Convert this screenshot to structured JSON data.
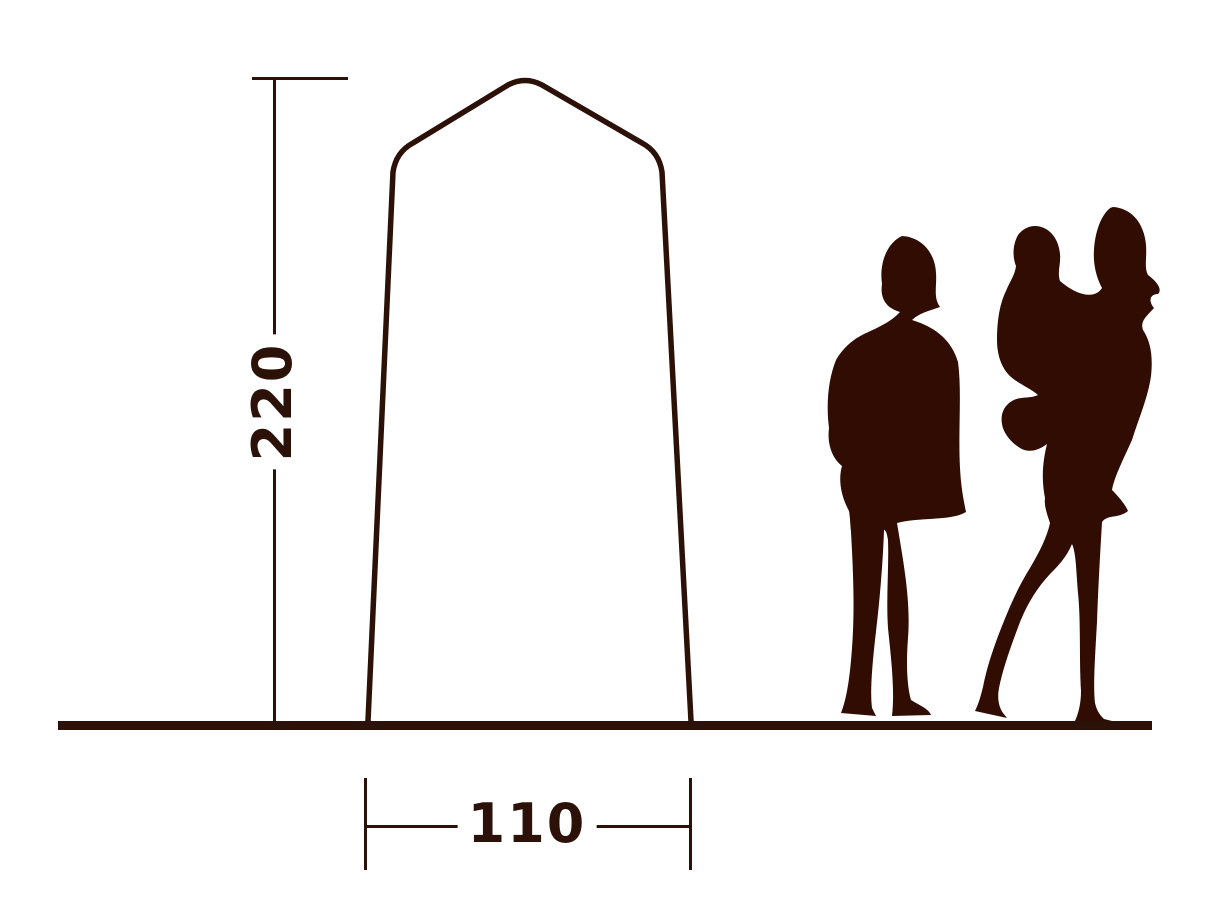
{
  "diagram": {
    "type": "tent-dimension-diagram",
    "height_dimension": {
      "value": "220",
      "orientation": "vertical"
    },
    "width_dimension": {
      "value": "110",
      "orientation": "horizontal"
    },
    "figures": [
      {
        "name": "standing-woman-silhouette"
      },
      {
        "name": "adult-carrying-child-silhouette"
      }
    ],
    "colors": {
      "ink": "#2c1108",
      "silhouette": "#300c03",
      "background": "#ffffff"
    }
  }
}
